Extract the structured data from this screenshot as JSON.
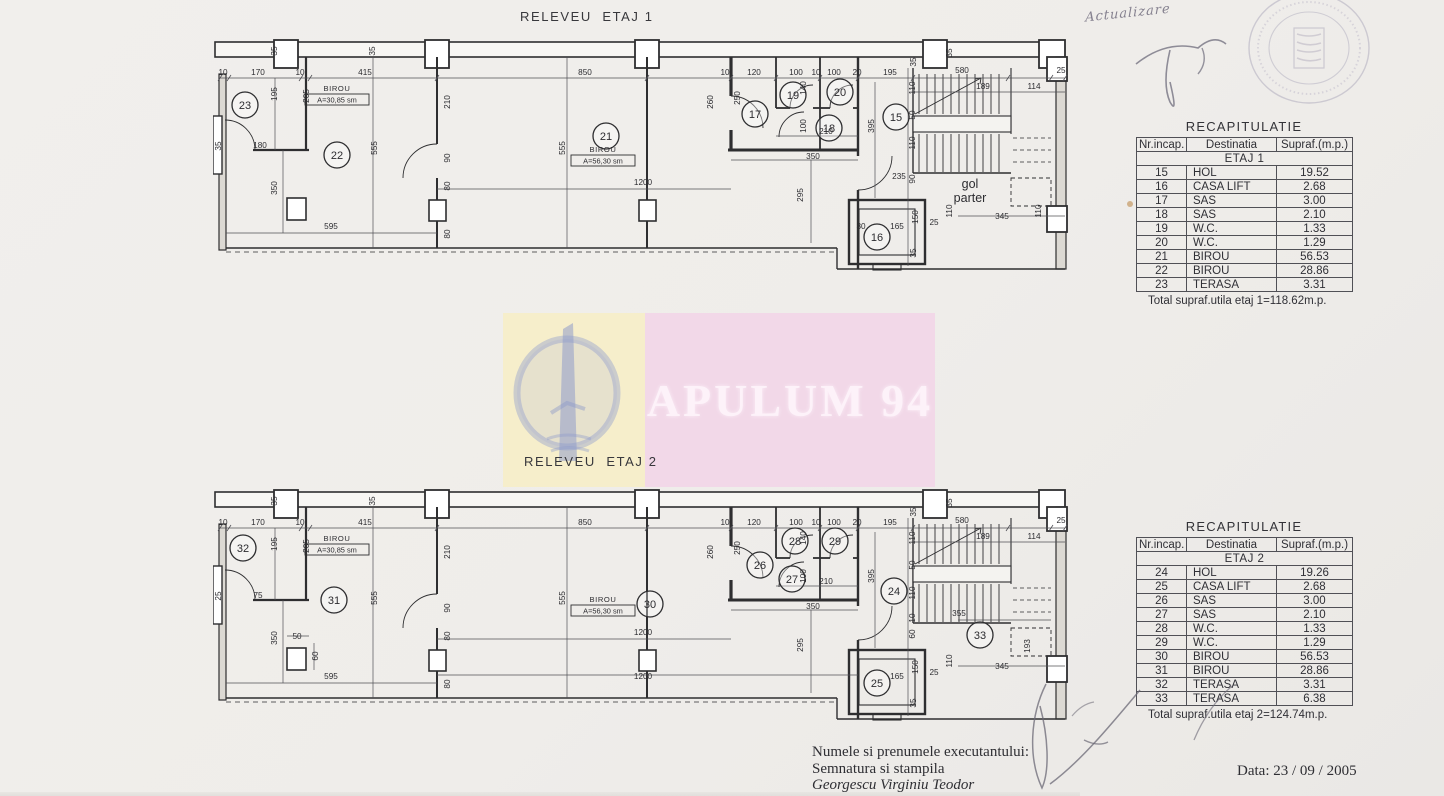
{
  "document": {
    "kind": "scanned architectural survey sheet",
    "background": "#efedea"
  },
  "handwriting": {
    "note": "Actualizare",
    "date": "Data: 23 / 09 / 2005"
  },
  "executor": {
    "line1": "Numele si prenumele executantului:",
    "line2": "Semnatura si stampila",
    "line3": "Georgescu Virginiu Teodor"
  },
  "watermark": {
    "text": "APULUM 94",
    "pink": "#f2d8e8",
    "yellow": "#f6eecb",
    "logo_blue": "#97a2cf"
  },
  "tables": [
    {
      "title": "RECAPITULATIE",
      "headers": [
        "Nr.incap.",
        "Destinatia",
        "Supraf.(m.p.)"
      ],
      "group": "ETAJ 1",
      "rows": [
        [
          "15",
          "HOL",
          "19.52"
        ],
        [
          "16",
          "CASA LIFT",
          "2.68"
        ],
        [
          "17",
          "SAS",
          "3.00"
        ],
        [
          "18",
          "SAS",
          "2.10"
        ],
        [
          "19",
          "W.C.",
          "1.33"
        ],
        [
          "20",
          "W.C.",
          "1.29"
        ],
        [
          "21",
          "BIROU",
          "56.53"
        ],
        [
          "22",
          "BIROU",
          "28.86"
        ],
        [
          "23",
          "TERASA",
          "3.31"
        ]
      ],
      "total": "Total supraf.utila etaj 1=118.62m.p."
    },
    {
      "title": "RECAPITULATIE",
      "headers": [
        "Nr.incap.",
        "Destinatia",
        "Supraf.(m.p.)"
      ],
      "group": "ETAJ 2",
      "rows": [
        [
          "24",
          "HOL",
          "19.26"
        ],
        [
          "25",
          "CASA LIFT",
          "2.68"
        ],
        [
          "26",
          "SAS",
          "3.00"
        ],
        [
          "27",
          "SAS",
          "2.10"
        ],
        [
          "28",
          "W.C.",
          "1.33"
        ],
        [
          "29",
          "W.C.",
          "1.29"
        ],
        [
          "30",
          "BIROU",
          "56.53"
        ],
        [
          "31",
          "BIROU",
          "28.86"
        ],
        [
          "32",
          "TERASA",
          "3.31"
        ],
        [
          "33",
          "TERASA",
          "6.38"
        ]
      ],
      "total": "Total supraf.utila etaj 2=124.74m.p."
    }
  ],
  "plans": [
    {
      "title": "RELEVEU  ETAJ 1",
      "rooms": [
        {
          "n": "23",
          "x": 32,
          "y": 67
        },
        {
          "n": "22",
          "x": 124,
          "y": 117
        },
        {
          "n": "21",
          "x": 393,
          "y": 98
        },
        {
          "n": "17",
          "x": 542,
          "y": 76
        },
        {
          "n": "19",
          "x": 580,
          "y": 57
        },
        {
          "n": "20",
          "x": 627,
          "y": 54
        },
        {
          "n": "18",
          "x": 616,
          "y": 90
        },
        {
          "n": "15",
          "x": 683,
          "y": 79
        },
        {
          "n": "16",
          "x": 664,
          "y": 199
        }
      ],
      "labels": [
        {
          "l1": "BIROU",
          "l2": "A=30,85 sm",
          "x": 124,
          "y": 53
        },
        {
          "l1": "BIROU",
          "l2": "A=56,30 sm",
          "x": 390,
          "y": 114
        }
      ],
      "big": {
        "lines": [
          "gol",
          "parter"
        ],
        "x": 757,
        "y": 150
      },
      "dims": [
        {
          "t": "10",
          "x": 10,
          "y": 37
        },
        {
          "t": "170",
          "x": 45,
          "y": 37
        },
        {
          "t": "10",
          "x": 87,
          "y": 37
        },
        {
          "t": "415",
          "x": 152,
          "y": 37
        },
        {
          "t": "850",
          "x": 372,
          "y": 37
        },
        {
          "t": "10",
          "x": 512,
          "y": 37
        },
        {
          "t": "120",
          "x": 541,
          "y": 37
        },
        {
          "t": "100",
          "x": 583,
          "y": 37
        },
        {
          "t": "10",
          "x": 603,
          "y": 37
        },
        {
          "t": "100",
          "x": 621,
          "y": 37
        },
        {
          "t": "20",
          "x": 644,
          "y": 37
        },
        {
          "t": "195",
          "x": 677,
          "y": 37
        },
        {
          "t": "580",
          "x": 749,
          "y": 35
        },
        {
          "t": "189",
          "x": 770,
          "y": 51
        },
        {
          "t": "114",
          "x": 821,
          "y": 51
        },
        {
          "t": "25",
          "x": 848,
          "y": 35
        },
        {
          "t": "35",
          "x": 64,
          "y": 13,
          "r": 1
        },
        {
          "t": "35",
          "x": 162,
          "y": 13,
          "r": 1
        },
        {
          "t": "35",
          "x": 703,
          "y": 24,
          "r": 1
        },
        {
          "t": "35",
          "x": 739,
          "y": 15,
          "r": 1
        },
        {
          "t": "195",
          "x": 64,
          "y": 56,
          "r": 1
        },
        {
          "t": "205",
          "x": 96,
          "y": 58,
          "r": 1
        },
        {
          "t": "35",
          "x": 8,
          "y": 108,
          "r": 1
        },
        {
          "t": "180",
          "x": 47,
          "y": 110
        },
        {
          "t": "350",
          "x": 64,
          "y": 150,
          "r": 1
        },
        {
          "t": "595",
          "x": 118,
          "y": 191
        },
        {
          "t": "555",
          "x": 164,
          "y": 110,
          "r": 1
        },
        {
          "t": "555",
          "x": 352,
          "y": 110,
          "r": 1
        },
        {
          "t": "1200",
          "x": 430,
          "y": 147
        },
        {
          "t": "210",
          "x": 237,
          "y": 64,
          "r": 1
        },
        {
          "t": "90",
          "x": 237,
          "y": 120,
          "r": 1
        },
        {
          "t": "80",
          "x": 237,
          "y": 148,
          "r": 1
        },
        {
          "t": "80",
          "x": 237,
          "y": 196,
          "r": 1
        },
        {
          "t": "260",
          "x": 500,
          "y": 64,
          "r": 1
        },
        {
          "t": "250",
          "x": 527,
          "y": 60,
          "r": 1
        },
        {
          "t": "140",
          "x": 593,
          "y": 50,
          "r": 1
        },
        {
          "t": "100",
          "x": 593,
          "y": 88,
          "r": 1
        },
        {
          "t": "210",
          "x": 613,
          "y": 96
        },
        {
          "t": "350",
          "x": 600,
          "y": 121
        },
        {
          "t": "295",
          "x": 590,
          "y": 157,
          "r": 1
        },
        {
          "t": "395",
          "x": 661,
          "y": 88,
          "r": 1
        },
        {
          "t": "110",
          "x": 702,
          "y": 50,
          "r": 1
        },
        {
          "t": "50",
          "x": 702,
          "y": 77,
          "r": 1
        },
        {
          "t": "110",
          "x": 702,
          "y": 105,
          "r": 1
        },
        {
          "t": "90",
          "x": 702,
          "y": 141,
          "r": 1
        },
        {
          "t": "235",
          "x": 686,
          "y": 141
        },
        {
          "t": "110",
          "x": 739,
          "y": 173,
          "r": 1
        },
        {
          "t": "345",
          "x": 789,
          "y": 181
        },
        {
          "t": "110",
          "x": 828,
          "y": 173,
          "r": 1
        },
        {
          "t": "30",
          "x": 648,
          "y": 191
        },
        {
          "t": "165",
          "x": 684,
          "y": 191
        },
        {
          "t": "150",
          "x": 705,
          "y": 179,
          "r": 1
        },
        {
          "t": "25",
          "x": 721,
          "y": 187
        },
        {
          "t": "35",
          "x": 703,
          "y": 215,
          "r": 1
        }
      ]
    },
    {
      "title": "RELEVEU  ETAJ 2",
      "rooms": [
        {
          "n": "32",
          "x": 30,
          "y": 60
        },
        {
          "n": "31",
          "x": 121,
          "y": 112
        },
        {
          "n": "30",
          "x": 437,
          "y": 116
        },
        {
          "n": "26",
          "x": 547,
          "y": 77
        },
        {
          "n": "28",
          "x": 582,
          "y": 53
        },
        {
          "n": "29",
          "x": 622,
          "y": 53
        },
        {
          "n": "27",
          "x": 579,
          "y": 91
        },
        {
          "n": "24",
          "x": 681,
          "y": 103
        },
        {
          "n": "25",
          "x": 664,
          "y": 195
        },
        {
          "n": "33",
          "x": 767,
          "y": 147
        }
      ],
      "labels": [
        {
          "l1": "BIROU",
          "l2": "A=30,85 sm",
          "x": 124,
          "y": 53
        },
        {
          "l1": "BIROU",
          "l2": "A=56,30 sm",
          "x": 390,
          "y": 114
        }
      ],
      "big": null,
      "dims": [
        {
          "t": "10",
          "x": 10,
          "y": 37
        },
        {
          "t": "170",
          "x": 45,
          "y": 37
        },
        {
          "t": "10",
          "x": 87,
          "y": 37
        },
        {
          "t": "415",
          "x": 152,
          "y": 37
        },
        {
          "t": "850",
          "x": 372,
          "y": 37
        },
        {
          "t": "10",
          "x": 512,
          "y": 37
        },
        {
          "t": "120",
          "x": 541,
          "y": 37
        },
        {
          "t": "100",
          "x": 583,
          "y": 37
        },
        {
          "t": "10",
          "x": 603,
          "y": 37
        },
        {
          "t": "100",
          "x": 621,
          "y": 37
        },
        {
          "t": "20",
          "x": 644,
          "y": 37
        },
        {
          "t": "195",
          "x": 677,
          "y": 37
        },
        {
          "t": "580",
          "x": 749,
          "y": 35
        },
        {
          "t": "189",
          "x": 770,
          "y": 51
        },
        {
          "t": "114",
          "x": 821,
          "y": 51
        },
        {
          "t": "25",
          "x": 848,
          "y": 35
        },
        {
          "t": "35",
          "x": 64,
          "y": 13,
          "r": 1
        },
        {
          "t": "35",
          "x": 162,
          "y": 13,
          "r": 1
        },
        {
          "t": "35",
          "x": 703,
          "y": 24,
          "r": 1
        },
        {
          "t": "35",
          "x": 739,
          "y": 15,
          "r": 1
        },
        {
          "t": "195",
          "x": 64,
          "y": 56,
          "r": 1
        },
        {
          "t": "205",
          "x": 96,
          "y": 58,
          "r": 1
        },
        {
          "t": "25",
          "x": 8,
          "y": 108,
          "r": 1
        },
        {
          "t": "75",
          "x": 45,
          "y": 110
        },
        {
          "t": "350",
          "x": 64,
          "y": 150,
          "r": 1
        },
        {
          "t": "595",
          "x": 118,
          "y": 191
        },
        {
          "t": "50",
          "x": 84,
          "y": 151
        },
        {
          "t": "60",
          "x": 105,
          "y": 168,
          "r": 1
        },
        {
          "t": "555",
          "x": 164,
          "y": 110,
          "r": 1
        },
        {
          "t": "555",
          "x": 352,
          "y": 110,
          "r": 1
        },
        {
          "t": "1200",
          "x": 430,
          "y": 147
        },
        {
          "t": "1200",
          "x": 430,
          "y": 191
        },
        {
          "t": "210",
          "x": 237,
          "y": 64,
          "r": 1
        },
        {
          "t": "90",
          "x": 237,
          "y": 120,
          "r": 1
        },
        {
          "t": "80",
          "x": 237,
          "y": 148,
          "r": 1
        },
        {
          "t": "80",
          "x": 237,
          "y": 196,
          "r": 1
        },
        {
          "t": "260",
          "x": 500,
          "y": 64,
          "r": 1
        },
        {
          "t": "250",
          "x": 527,
          "y": 60,
          "r": 1
        },
        {
          "t": "140",
          "x": 593,
          "y": 50,
          "r": 1
        },
        {
          "t": "100",
          "x": 593,
          "y": 88,
          "r": 1
        },
        {
          "t": "210",
          "x": 613,
          "y": 96
        },
        {
          "t": "350",
          "x": 600,
          "y": 121
        },
        {
          "t": "295",
          "x": 590,
          "y": 157,
          "r": 1
        },
        {
          "t": "395",
          "x": 661,
          "y": 88,
          "r": 1
        },
        {
          "t": "110",
          "x": 702,
          "y": 50,
          "r": 1
        },
        {
          "t": "50",
          "x": 702,
          "y": 77,
          "r": 1
        },
        {
          "t": "110",
          "x": 702,
          "y": 105,
          "r": 1
        },
        {
          "t": "10",
          "x": 702,
          "y": 130,
          "r": 1
        },
        {
          "t": "60",
          "x": 702,
          "y": 146,
          "r": 1
        },
        {
          "t": "355",
          "x": 746,
          "y": 128
        },
        {
          "t": "193",
          "x": 817,
          "y": 158,
          "r": 1
        },
        {
          "t": "110",
          "x": 739,
          "y": 173,
          "r": 1
        },
        {
          "t": "345",
          "x": 789,
          "y": 181
        },
        {
          "t": "165",
          "x": 684,
          "y": 191
        },
        {
          "t": "150",
          "x": 705,
          "y": 179,
          "r": 1
        },
        {
          "t": "25",
          "x": 721,
          "y": 187
        },
        {
          "t": "35",
          "x": 703,
          "y": 215,
          "r": 1
        }
      ]
    }
  ]
}
